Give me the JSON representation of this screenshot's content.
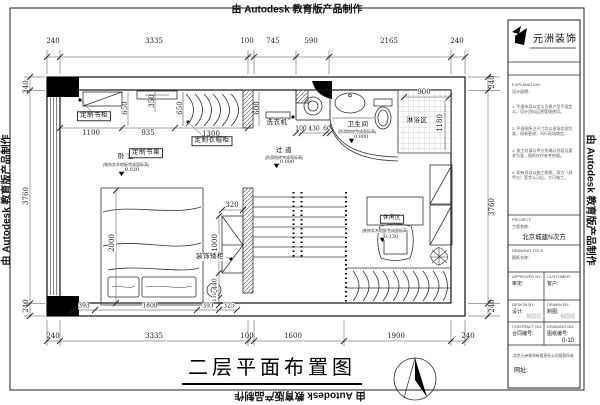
{
  "edge": {
    "top": "由 Autodesk 教育版产品制作",
    "bottom": "由 Autodesk 教育版产品制作",
    "left": "由 Autodesk 教育版产品制作",
    "right": "由 Autodesk 教育版产品制作"
  },
  "title": "二层平面布置图",
  "dims": {
    "top": [
      "240",
      "3335",
      "100",
      "745",
      "590",
      "2165",
      "240"
    ],
    "bottom": [
      "240",
      "3335",
      "100",
      "1600",
      "1900",
      "240"
    ],
    "left": [
      "240",
      "3760",
      "240"
    ],
    "right": [
      "240",
      "3760",
      "240"
    ],
    "inner": {
      "d350": "350",
      "d650a": "650",
      "d650b": "650",
      "d600": "600",
      "d1100": "1100",
      "d935": "935",
      "d1300": "1300",
      "d900": "900",
      "d1180": "1180",
      "d100": "100",
      "d430": "430",
      "d60": "60",
      "d2000": "2000",
      "d320": "320",
      "d1000": "1000",
      "d440": "440",
      "d130": "130",
      "d393a": "393",
      "d1800": "1800",
      "d393b": "393",
      "d325": "325"
    }
  },
  "rooms": {
    "bedroom": {
      "name": "卧 室",
      "note": "(装饰实木地板完成面标高)",
      "level": "0.020"
    },
    "bathroom": {
      "name": "卫生间",
      "note": "(防滑地砖完成面标高)",
      "level": "0.000"
    },
    "corridor": {
      "name": "过 道",
      "note": "(防滑地砖完成面标高)",
      "level": "0.000"
    },
    "shower": {
      "name": "淋浴区"
    },
    "leisure": {
      "name": "休闲区",
      "note": "(装饰实木地板完成面标高)",
      "level": "0.130"
    }
  },
  "furniture": {
    "bookcase": "定制书柜",
    "desk": "定制书桌",
    "wardrobe": "定制衣帽柜",
    "washer": "洗衣机",
    "low_cabinet": "装饰矮柜"
  },
  "titleblock": {
    "logo": "元洲装饰",
    "explanation_en": "EXPLANATION:",
    "explanation_cn": "设计说明:",
    "notes": [
      "1. 平面布局以定义为原户型平面定义，设计资料运营管理使用。",
      "2. 平面图所注尺寸均以现场实测为准，如有更改，另行现场商定。",
      "3. 施工时请以甲方所确认内容及要求为准，图纸仅作参考依据。",
      "4. 如有异议以施工图纸、双方（经甲方）签字认可后，方可施工。"
    ],
    "project_en": "PROJECT:",
    "project_cn": "工程名称:",
    "project_value": "北京城建N次方",
    "drawing_title_en": "DRAWING TITLE:",
    "drawing_title_cn": "图纸名称:",
    "approved_en": "APPROVED BY:",
    "approved_cn": "审定:",
    "customer_en": "CUSTOMER:",
    "customer_cn": "客户:",
    "design_en": "DESIGN BY:",
    "design_cn": "设计:",
    "design_sign": "相国强",
    "drawn_en": "DRAWN BY:",
    "drawn_cn": "制图:",
    "drawn_sign": "相国强",
    "contract_en": "CONTRACT NO:",
    "contract_cn": "合同编号:",
    "drawingno_en": "DRAWING NO:",
    "drawingno_cn": "图纸编号:",
    "drawingno_value": "0-10",
    "copyright": "北京元洲装饰有限责任公司版权所有",
    "website": "网址:"
  }
}
